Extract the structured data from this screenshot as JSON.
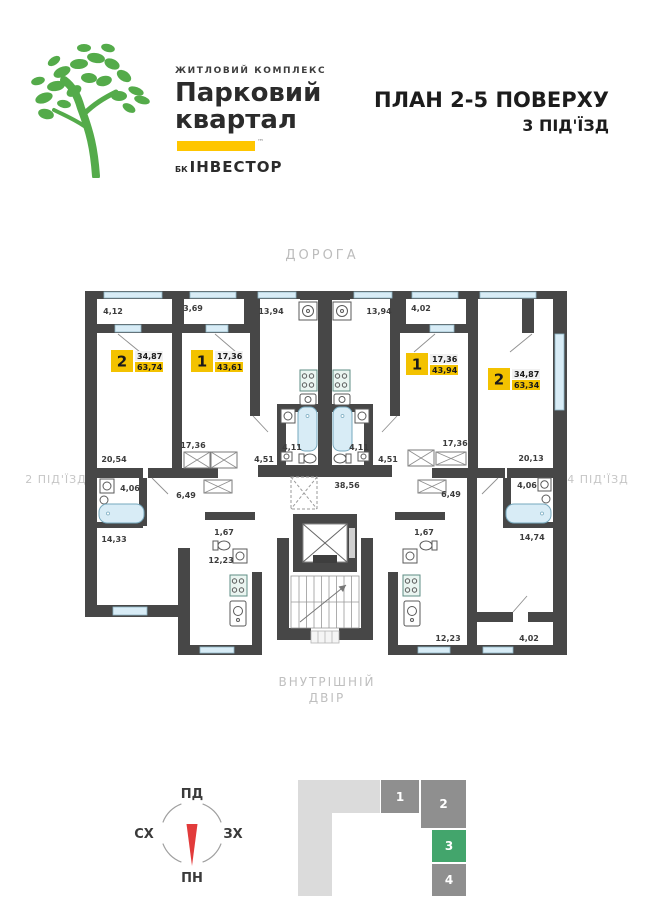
{
  "logo": {
    "complex_type": "ЖИТЛОВИЙ КОМПЛЕКС",
    "name_line1": "Парковий",
    "name_line2": "квартал",
    "developer_prefix": "БК",
    "developer": "ІНВЕСТОР",
    "trademark": "™"
  },
  "title": {
    "line1": "ПЛАН 2-5 ПОВЕРХУ",
    "line2": "3 ПІД'ЇЗД"
  },
  "surroundings": {
    "top": "ДОРОГА",
    "bottom_line1": "ВНУТРІШНІЙ",
    "bottom_line2": "ДВІР",
    "left": "2 ПІД'ЇЗД",
    "right": "4 ПІД'ЇЗД"
  },
  "plan": {
    "apartments": [
      {
        "number": "2",
        "rooms_area": "34,87",
        "total_area": "63,74",
        "x": 111,
        "y": 350
      },
      {
        "number": "1",
        "rooms_area": "17,36",
        "total_area": "43,61",
        "x": 191,
        "y": 350
      },
      {
        "number": "1",
        "rooms_area": "17,36",
        "total_area": "43,94",
        "x": 406,
        "y": 353
      },
      {
        "number": "2",
        "rooms_area": "34,87",
        "total_area": "63,34",
        "x": 488,
        "y": 368
      }
    ],
    "room_labels": [
      {
        "text": "4,12",
        "x": 113,
        "y": 314
      },
      {
        "text": "3,69",
        "x": 193,
        "y": 311
      },
      {
        "text": "13,94",
        "x": 271,
        "y": 314
      },
      {
        "text": "13,94",
        "x": 379,
        "y": 314
      },
      {
        "text": "4,02",
        "x": 421,
        "y": 311
      },
      {
        "text": "17,36",
        "x": 193,
        "y": 448
      },
      {
        "text": "17,36",
        "x": 455,
        "y": 446
      },
      {
        "text": "4,11",
        "x": 292,
        "y": 450
      },
      {
        "text": "4,11",
        "x": 359,
        "y": 450
      },
      {
        "text": "4,51",
        "x": 264,
        "y": 462
      },
      {
        "text": "4,51",
        "x": 388,
        "y": 462
      },
      {
        "text": "20,54",
        "x": 114,
        "y": 462
      },
      {
        "text": "20,13",
        "x": 531,
        "y": 461
      },
      {
        "text": "4,06",
        "x": 130,
        "y": 491
      },
      {
        "text": "4,06",
        "x": 527,
        "y": 488
      },
      {
        "text": "6,49",
        "x": 186,
        "y": 498
      },
      {
        "text": "6,49",
        "x": 451,
        "y": 497
      },
      {
        "text": "38,56",
        "x": 347,
        "y": 488
      },
      {
        "text": "1,67",
        "x": 224,
        "y": 535
      },
      {
        "text": "1,67",
        "x": 424,
        "y": 535
      },
      {
        "text": "14,33",
        "x": 114,
        "y": 542
      },
      {
        "text": "14,74",
        "x": 532,
        "y": 540
      },
      {
        "text": "12,23",
        "x": 221,
        "y": 563
      },
      {
        "text": "12,23",
        "x": 448,
        "y": 641
      },
      {
        "text": "4,02",
        "x": 529,
        "y": 641
      }
    ]
  },
  "compass": {
    "top": "ПД",
    "left": "СХ",
    "right": "ЗХ",
    "bottom": "ПН",
    "needle_color": "#e23b3b"
  },
  "position_indicator": {
    "blocks": [
      {
        "label": "1",
        "active": false
      },
      {
        "label": "2",
        "active": false
      },
      {
        "label": "3",
        "active": true
      },
      {
        "label": "4",
        "active": false
      }
    ],
    "active_color": "#43a56c",
    "inactive_color": "#8f8f8f",
    "outline_color": "#dbdbdb"
  },
  "colors": {
    "accent_yellow": "#f3c200",
    "logo_green": "#54ab4a",
    "wall": "#474747",
    "window_blue": "#d8ecf6",
    "label_gray": "#bcbcbc"
  }
}
